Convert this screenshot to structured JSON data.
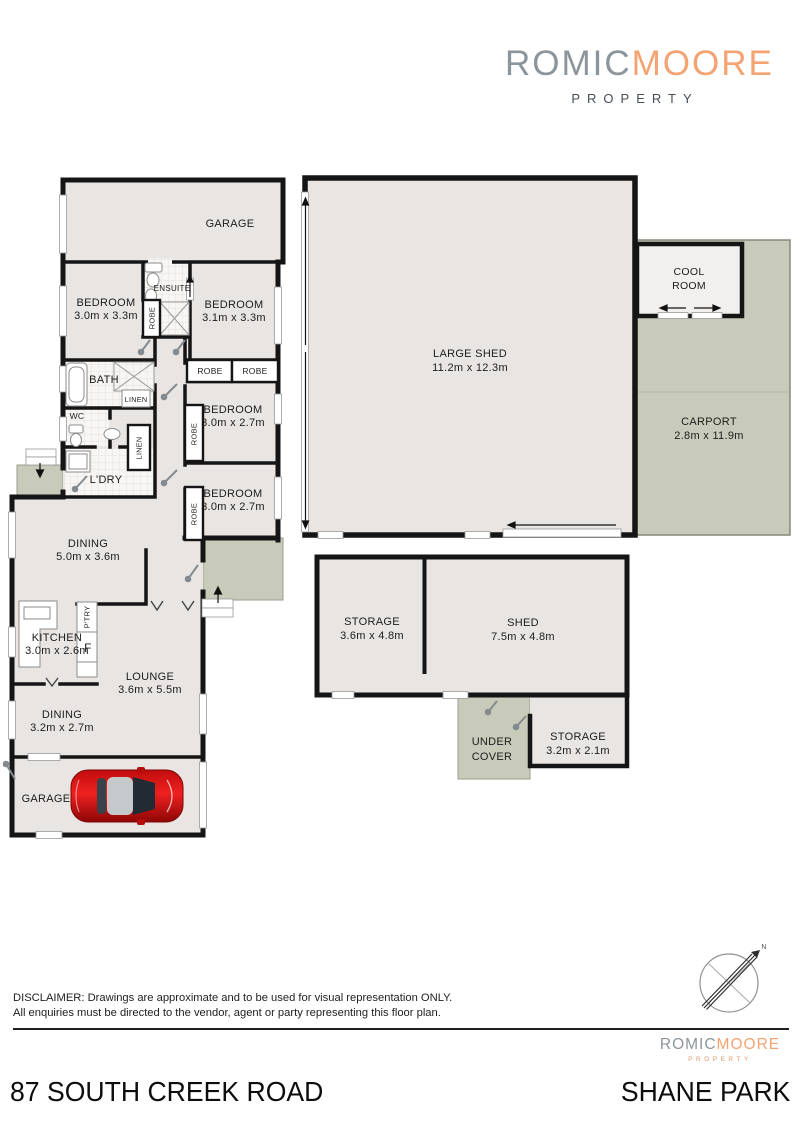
{
  "brand": {
    "part1": "ROMIC",
    "part2": "MOORE",
    "tagline": "PROPERTY"
  },
  "colors": {
    "accent_orange": "#f4a372",
    "logo_gray": "#8c959b",
    "floor": "#e9e5e3",
    "outdoor": "#c9cbba",
    "wall": "#151515",
    "car_red": "#d31111"
  },
  "plan": {
    "rooms": {
      "garage_top": "GARAGE",
      "bedroom1": {
        "name": "BEDROOM",
        "dims": "3.0m x 3.3m"
      },
      "ensuite": "ENSUITE",
      "robe_ensuite": "ROBE",
      "bedroom2": {
        "name": "BEDROOM",
        "dims": "3.1m x 3.3m"
      },
      "robe_left": "ROBE",
      "robe_right": "ROBE",
      "bath": "BATH",
      "linen_bath": "LINEN",
      "wc": "WC",
      "linen_hall": "LINEN",
      "laundry": "L'DRY",
      "bedroom3": {
        "name": "BEDROOM",
        "dims": "3.0m x 2.7m"
      },
      "robe3": "ROBE",
      "bedroom4": {
        "name": "BEDROOM",
        "dims": "3.0m x 2.7m"
      },
      "robe4": "ROBE",
      "dining1": {
        "name": "DINING",
        "dims": "5.0m x 3.6m"
      },
      "pantry": "P'TRY",
      "kitchen": {
        "name": "KITCHEN",
        "dims": "3.0m x 2.6m"
      },
      "fridge": "F",
      "lounge": {
        "name": "LOUNGE",
        "dims": "3.6m x 5.5m"
      },
      "dining2": {
        "name": "DINING",
        "dims": "3.2m x 2.7m"
      },
      "garage_bottom": "GARAGE",
      "large_shed": {
        "name": "LARGE SHED",
        "dims": "11.2m x 12.3m"
      },
      "cool_room": {
        "line1": "COOL",
        "line2": "ROOM"
      },
      "carport": {
        "name": "CARPORT",
        "dims": "2.8m x 11.9m"
      },
      "storage1": {
        "name": "STORAGE",
        "dims": "3.6m x 4.8m"
      },
      "shed2": {
        "name": "SHED",
        "dims": "7.5m x 4.8m"
      },
      "under_cover": {
        "line1": "UNDER",
        "line2": "COVER"
      },
      "storage2": {
        "name": "STORAGE",
        "dims": "3.2m x 2.1m"
      }
    }
  },
  "compass": {
    "north": "N"
  },
  "disclaimer": {
    "line1": "DISCLAIMER: Drawings are approximate and to be used for visual representation ONLY.",
    "line2": "All enquiries must be directed to the vendor, agent or party representing this floor plan."
  },
  "address": {
    "street": "87 SOUTH CREEK ROAD",
    "suburb": "SHANE PARK"
  }
}
